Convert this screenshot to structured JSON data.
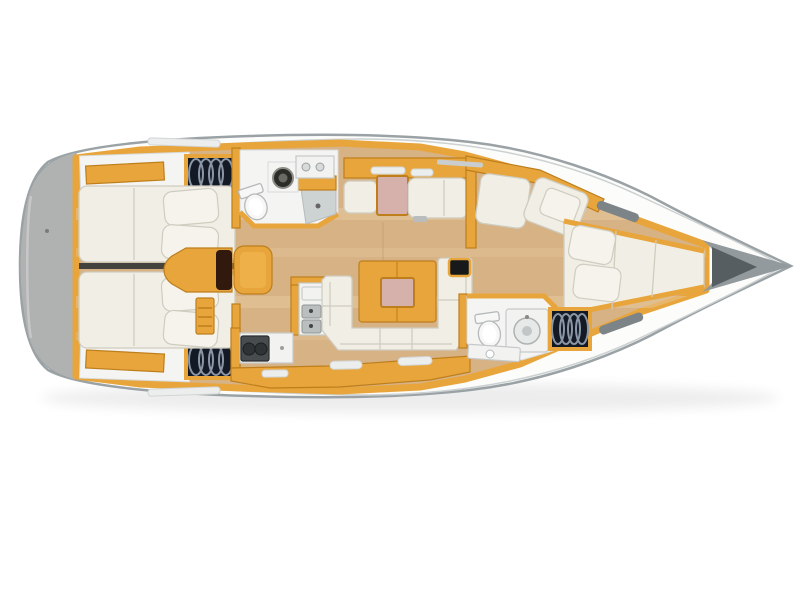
{
  "meta": {
    "title": "Sailing yacht interior layout — top-down deck plan, bow to the right",
    "view": "overhead 3D-rendered floor plan",
    "orientation": "bow right, stern left"
  },
  "colors": {
    "deck_white": "#fcfcfb",
    "hull_line": "#9aa2a5",
    "hull_inner_line": "#ccd1d2",
    "transom_gray": "#b0b2b1",
    "bow_deck_gray": "#939a9d",
    "anchor_locker_gray": "#575e62",
    "wood": "#e8a53c",
    "wood_dark": "#bd7e1b",
    "floor": "#d7b285",
    "floor_light": "#e8cda2",
    "upholstery": "#f1eee5",
    "upholstery_line": "#cfccc0",
    "pillow": "#f5f3ec",
    "table_pink": "#d6b0ab",
    "counter": "#f2f3f1",
    "counter_line": "#c5c9c9",
    "gray_floor": "#cdd2d2",
    "sink_gray": "#b9bfbf",
    "stove_dark": "#484c4f",
    "burner": "#2f3335",
    "locker_dark": "#131a26",
    "locker_arc": "#8b97a6",
    "hatch_slot": "#7d8487",
    "slot_light": "#eceeed",
    "bulkhead_dark": "#44423c",
    "nav_seat_brown": "#31190e"
  },
  "regions": {
    "hull": "Hull and side decks",
    "transom": "Stern transom and swim platform",
    "aft_cabin_port": "Aft double cabin (port, top) with berth and pillows",
    "aft_cabin_starboard": "Aft double cabin (starboard, bottom) with berth and pillows",
    "wardrobe": "Hanging locker with stowed gear",
    "chart_table": "Centreline chart table with seat",
    "companionway": "Companionway steps",
    "aft_head": "Aft head: toilet, washbasin and shower",
    "galley": "L-shaped galley: twin sinks, two-burner stove, fridge",
    "salon": "Salon: U-shaped settee, folding table and side bench with table",
    "forward_seating": "Forward bench seating with cushions",
    "forward_cabin": "Forward V-berth cabin",
    "forward_head": "Forward head: toilet and washbasin",
    "anchor_locker": "Anchor locker at bow",
    "deck_hatch": "Deck hatch"
  }
}
